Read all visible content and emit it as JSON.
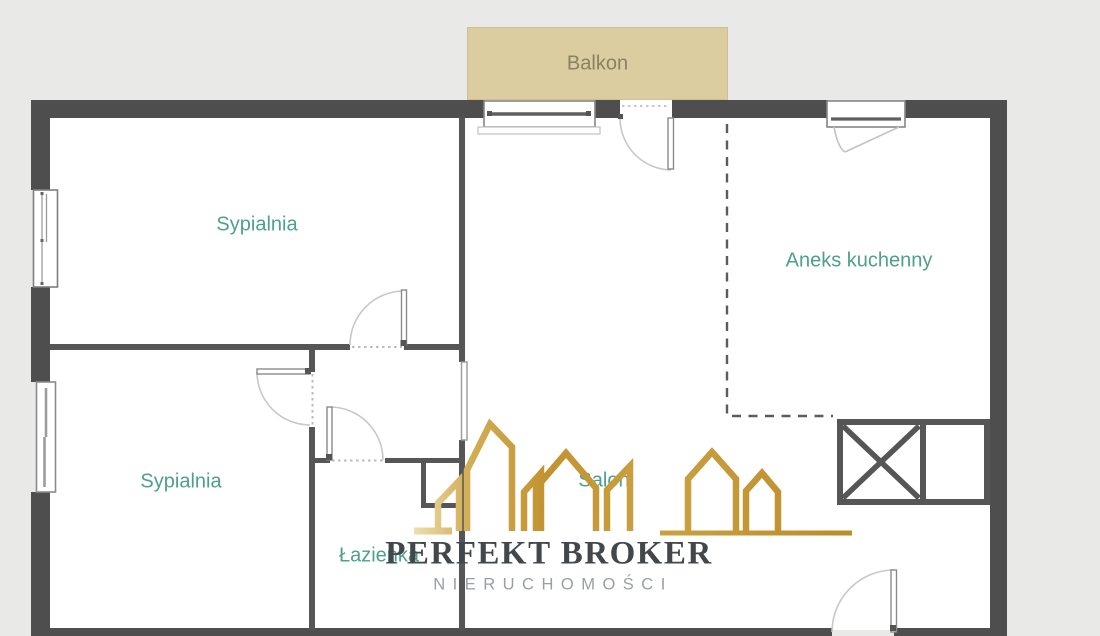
{
  "plan": {
    "type": "apartment-floor-plan",
    "language": "pl",
    "balcony": {
      "label": "Balkon"
    },
    "rooms": [
      {
        "id": "bedroom-top",
        "label": "Sypialnia"
      },
      {
        "id": "bedroom-bottom",
        "label": "Sypialnia"
      },
      {
        "id": "kitchen-annex",
        "label": "Aneks kuchenny"
      },
      {
        "id": "living-room",
        "label": "Salon"
      },
      {
        "id": "bathroom",
        "label": "Łazienka"
      }
    ],
    "features": [
      "balcony-window",
      "balcony-door",
      "kitchen-window",
      "entrance-door",
      "bedroom-top-door",
      "bedroom-bottom-door",
      "bathroom-door",
      "living-room-door",
      "kitchen-counter-with-x",
      "duct-shaft",
      "dashed-kitchen-boundary",
      "left-wall-window-top",
      "left-wall-window-bottom"
    ]
  },
  "logo": {
    "name": "PERFEKT BROKER",
    "tagline": "NIERUCHOMOŚCI"
  },
  "colors": {
    "background": "#e9e9e8",
    "floor": "#ffffff",
    "wall": "#4e4e4e",
    "interior_wall": "#565656",
    "room_label": "#4da08c",
    "balcony_fill": "#dccda1",
    "balcony_label": "#8a8063",
    "door_arc": "#c8c8c8",
    "logo_gold": "#c2922f",
    "logo_text": "#42474b",
    "logo_tagline": "#9a9fa2"
  }
}
